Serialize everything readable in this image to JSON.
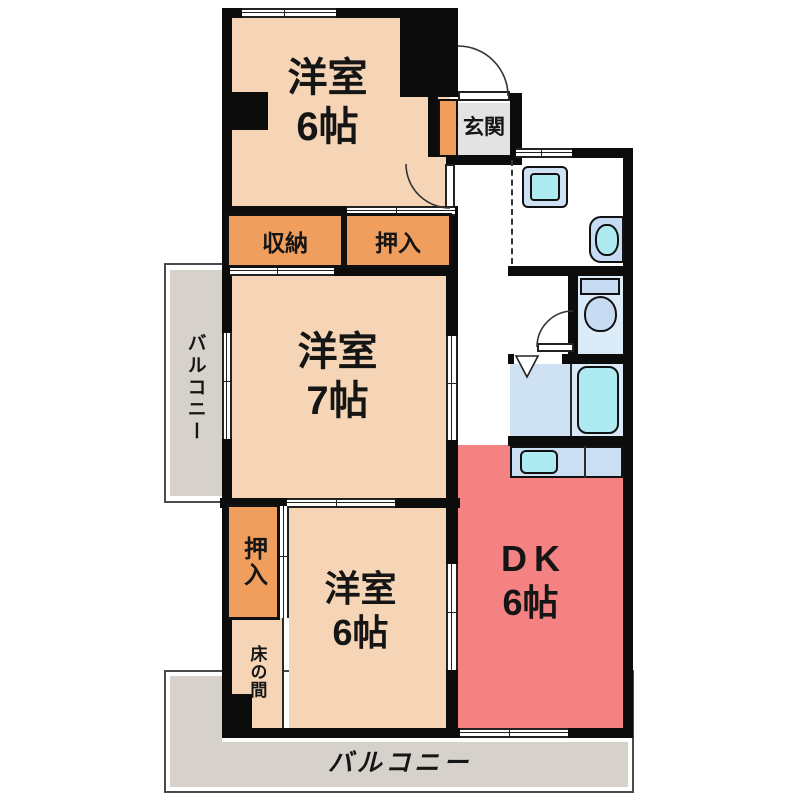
{
  "rooms": {
    "western_top": {
      "name": "洋室",
      "size": "6帖"
    },
    "western_mid": {
      "name": "洋室",
      "size": "7帖"
    },
    "western_bottom": {
      "name": "洋室",
      "size": "6帖"
    },
    "dining_kitchen": {
      "name": "DK",
      "size": "6帖"
    }
  },
  "closets": {
    "shunou": "収納",
    "oshiire_top": "押入",
    "oshiire_side": "押入",
    "tokonoma": "床の間"
  },
  "entrance": {
    "label": "玄関"
  },
  "balconies": {
    "left": "バルコニー",
    "bottom": "バルコニー"
  },
  "fixtures": [
    "washing-machine",
    "wash-basin",
    "toilet",
    "bathtub",
    "kitchen-sink"
  ],
  "colors": {
    "wall": "#0c0c0c",
    "room_peach": "#f5d5b5",
    "closet_orange": "#f09e5e",
    "dk_salmon": "#f58282",
    "balcony_gray": "#d6d1ca",
    "entrance_gray": "#e3e3e3",
    "fixture_cyan": "#aeeaf2",
    "fixture_blue": "#cfe2f4"
  }
}
